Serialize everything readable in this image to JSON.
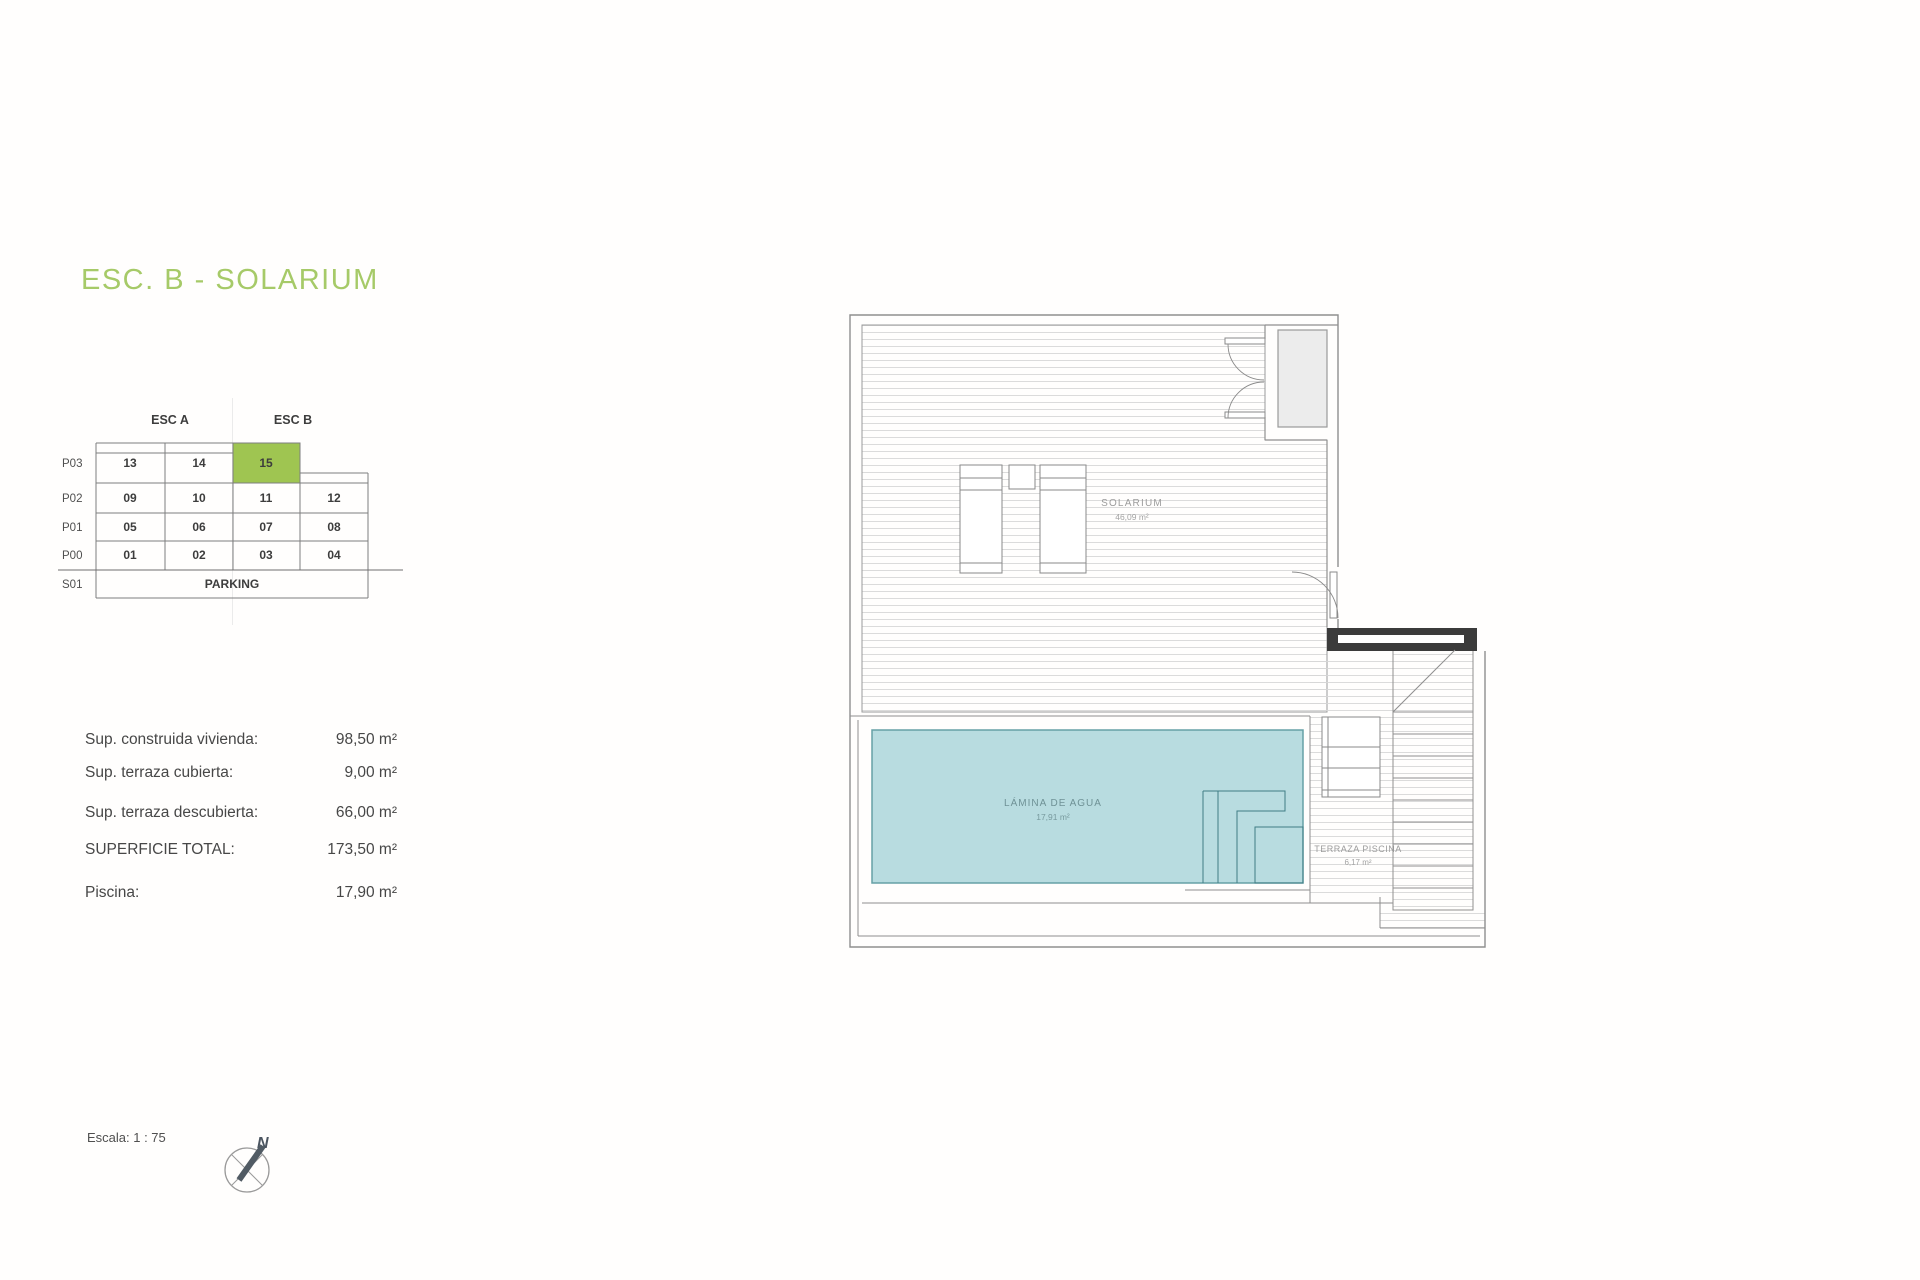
{
  "title": {
    "text": "ESC. B - SOLARIUM",
    "color": "#a6ca68"
  },
  "unit_table": {
    "headers": [
      {
        "label": "ESC A"
      },
      {
        "label": "ESC B"
      }
    ],
    "rows": [
      {
        "label": "P03",
        "cells": [
          "13",
          "14",
          "15"
        ]
      },
      {
        "label": "P02",
        "cells": [
          "09",
          "10",
          "11",
          "12"
        ]
      },
      {
        "label": "P01",
        "cells": [
          "05",
          "06",
          "07",
          "08"
        ]
      },
      {
        "label": "P00",
        "cells": [
          "01",
          "02",
          "03",
          "04"
        ]
      },
      {
        "label": "S01",
        "cells": [
          "PARKING"
        ]
      }
    ],
    "highlighted_unit": "15",
    "highlight_color": "#9fc551"
  },
  "areas": {
    "rows": [
      {
        "label": "Sup. construida vivienda:",
        "value": "98,50 m²"
      },
      {
        "label": "Sup. terraza cubierta:",
        "value": "9,00 m²"
      },
      {
        "label": "Sup. terraza descubierta:",
        "value": "66,00 m²"
      },
      {
        "label": "SUPERFICIE TOTAL:",
        "value": "173,50 m²"
      },
      {
        "label": "Piscina:",
        "value": "17,90 m²"
      }
    ]
  },
  "footer": {
    "scale_label": "Escala: 1 : 75",
    "north_label": "N"
  },
  "plan": {
    "labels": {
      "solarium": {
        "name": "SOLARIUM",
        "area": "46,09 m²"
      },
      "pool": {
        "name": "LÁMINA DE AGUA",
        "area": "17,91 m²"
      },
      "pool_terrace": {
        "name": "TERRAZA PISCINA",
        "area": "6,17 m²"
      }
    },
    "colors": {
      "water": "#b8dce0",
      "water_edge": "#66a0a6",
      "section_bar": "#3b3b3b",
      "wall": "#8f8f8f",
      "deck_hatch": "#d7d7d7"
    }
  }
}
